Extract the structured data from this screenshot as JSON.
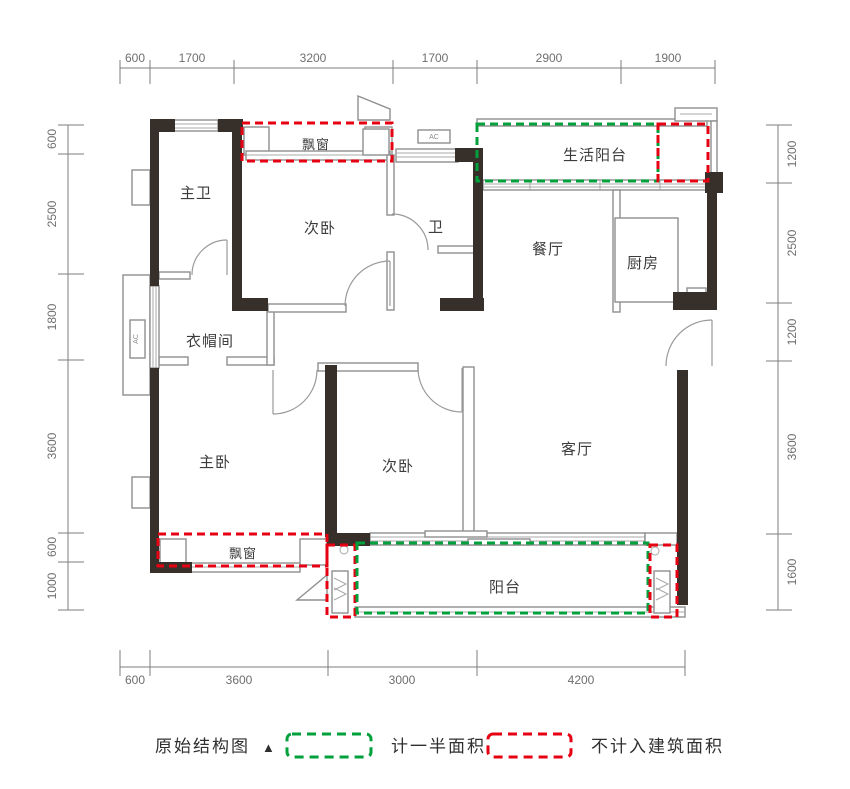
{
  "rooms": {
    "master_bath": "主卫",
    "bedroom_top": "次卧",
    "bath": "卫",
    "dining": "餐厅",
    "kitchen": "厨房",
    "service_balcony": "生活阳台",
    "cloakroom": "衣帽间",
    "master_bedroom": "主卧",
    "bedroom_bottom": "次卧",
    "living": "客厅",
    "balcony": "阳台",
    "bay_window_top": "飘窗",
    "bay_window_bottom": "飘窗"
  },
  "ac_label": "AC",
  "dims": {
    "top": [
      "600",
      "1700",
      "3200",
      "1700",
      "2900",
      "1900"
    ],
    "left": [
      "600",
      "2500",
      "1800",
      "3600",
      "600",
      "1000"
    ],
    "right": [
      "1200",
      "2500",
      "1200",
      "3600",
      "1600"
    ],
    "bottom": [
      "600",
      "3600",
      "3000",
      "4200"
    ]
  },
  "legend": {
    "original": "原始结构图",
    "marker": "▲",
    "half_area": "计一半面积",
    "excluded": "不计入建筑面积"
  },
  "colors": {
    "wall": "#372f2a",
    "red": "#e60012",
    "green": "#00a03c"
  }
}
